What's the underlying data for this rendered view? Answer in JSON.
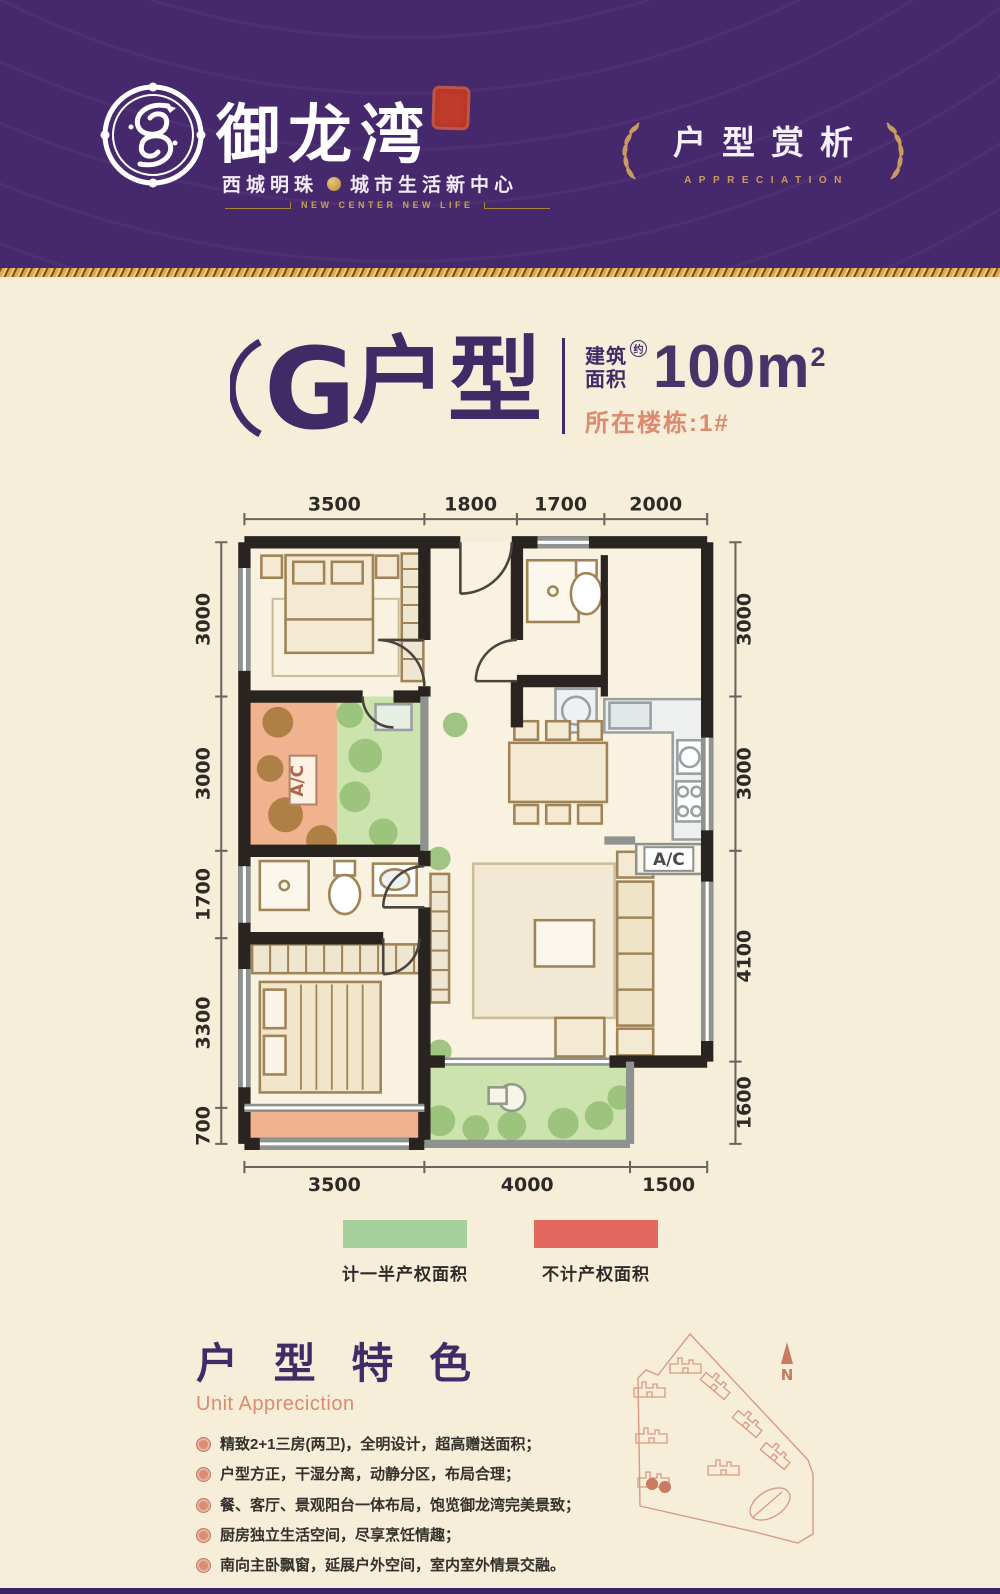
{
  "header": {
    "brand": "御龙湾",
    "tagline_cn_left": "西城明珠",
    "tagline_cn_right": "城市生活新中心",
    "tagline_en": "NEW CENTER NEW LIFE",
    "section_title": "户型赏析",
    "section_subtitle": "APPRECIATION"
  },
  "unit_title": {
    "letter": "G",
    "suffix": "户型",
    "area_label_top": "建筑",
    "area_label_bottom": "面积",
    "area_note": "约",
    "area_value": "100m",
    "area_exponent": "2",
    "building": "所在楼栋:1#"
  },
  "floorplan": {
    "dims_top": [
      "3500",
      "1800",
      "1700",
      "2000"
    ],
    "dims_left": [
      "3000",
      "3000",
      "1700",
      "3300",
      "700"
    ],
    "dims_right": [
      "3000",
      "3000",
      "4100",
      "1600"
    ],
    "dims_bottom": [
      "3500",
      "4000",
      "1500"
    ],
    "ac_label_balcony": "A/C",
    "ac_label_platform": "A/C"
  },
  "legend": {
    "half_property": {
      "label": "计一半产权面积",
      "color": "#a6d19d"
    },
    "no_property": {
      "label": "不计产权面积",
      "color": "#e2685f"
    }
  },
  "features": {
    "title": "户 型 特 色",
    "subtitle": "Unit Appreciction",
    "items": [
      "精致2+1三房(两卫)，全明设计，超高赠送面积；",
      "户型方正，干湿分离，动静分区，布局合理；",
      "餐、客厅、景观阳台一体布局，饱览御龙湾完美景致；",
      "厨房独立生活空间，尽享烹饪情趣；",
      "南向主卧飘窗，延展户外空间，室内室外情景交融。"
    ]
  },
  "siteplan": {
    "north": "N"
  },
  "colors": {
    "header_purple": "#46296d",
    "gold": "#c99a52",
    "cream_background": "#f6eed9",
    "title_purple": "#3f2c66",
    "salmon": "#dd8a6e",
    "legend_green": "#a6d19d",
    "legend_red": "#e2685f",
    "plan_orange": "#f0b28f",
    "plan_green": "#cde3ad"
  }
}
